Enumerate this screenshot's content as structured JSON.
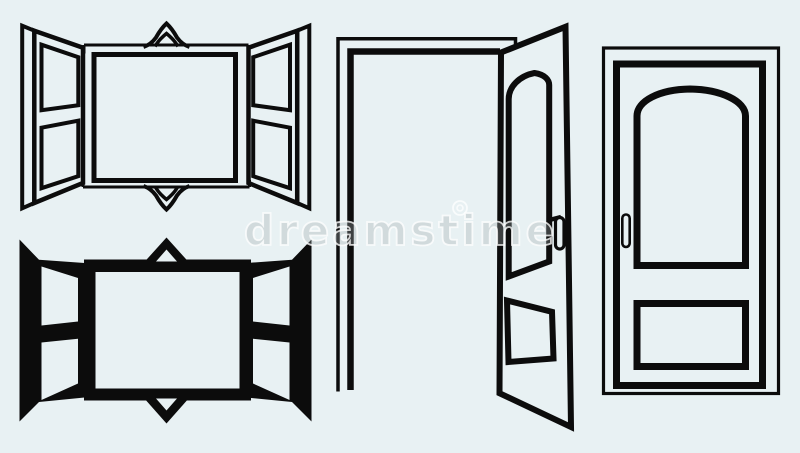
{
  "canvas": {
    "width": 800,
    "height": 453,
    "background_color": "#e8f1f3",
    "ink_color": "#0c0c0c"
  },
  "watermark": {
    "text": "dreamstime",
    "stroke_color": "rgba(255,255,255,0.78)"
  },
  "figures": [
    {
      "name": "open-window-outline-icon"
    },
    {
      "name": "open-window-silhouette-icon"
    },
    {
      "name": "open-door-outline-icon"
    },
    {
      "name": "closed-door-outline-icon"
    }
  ]
}
